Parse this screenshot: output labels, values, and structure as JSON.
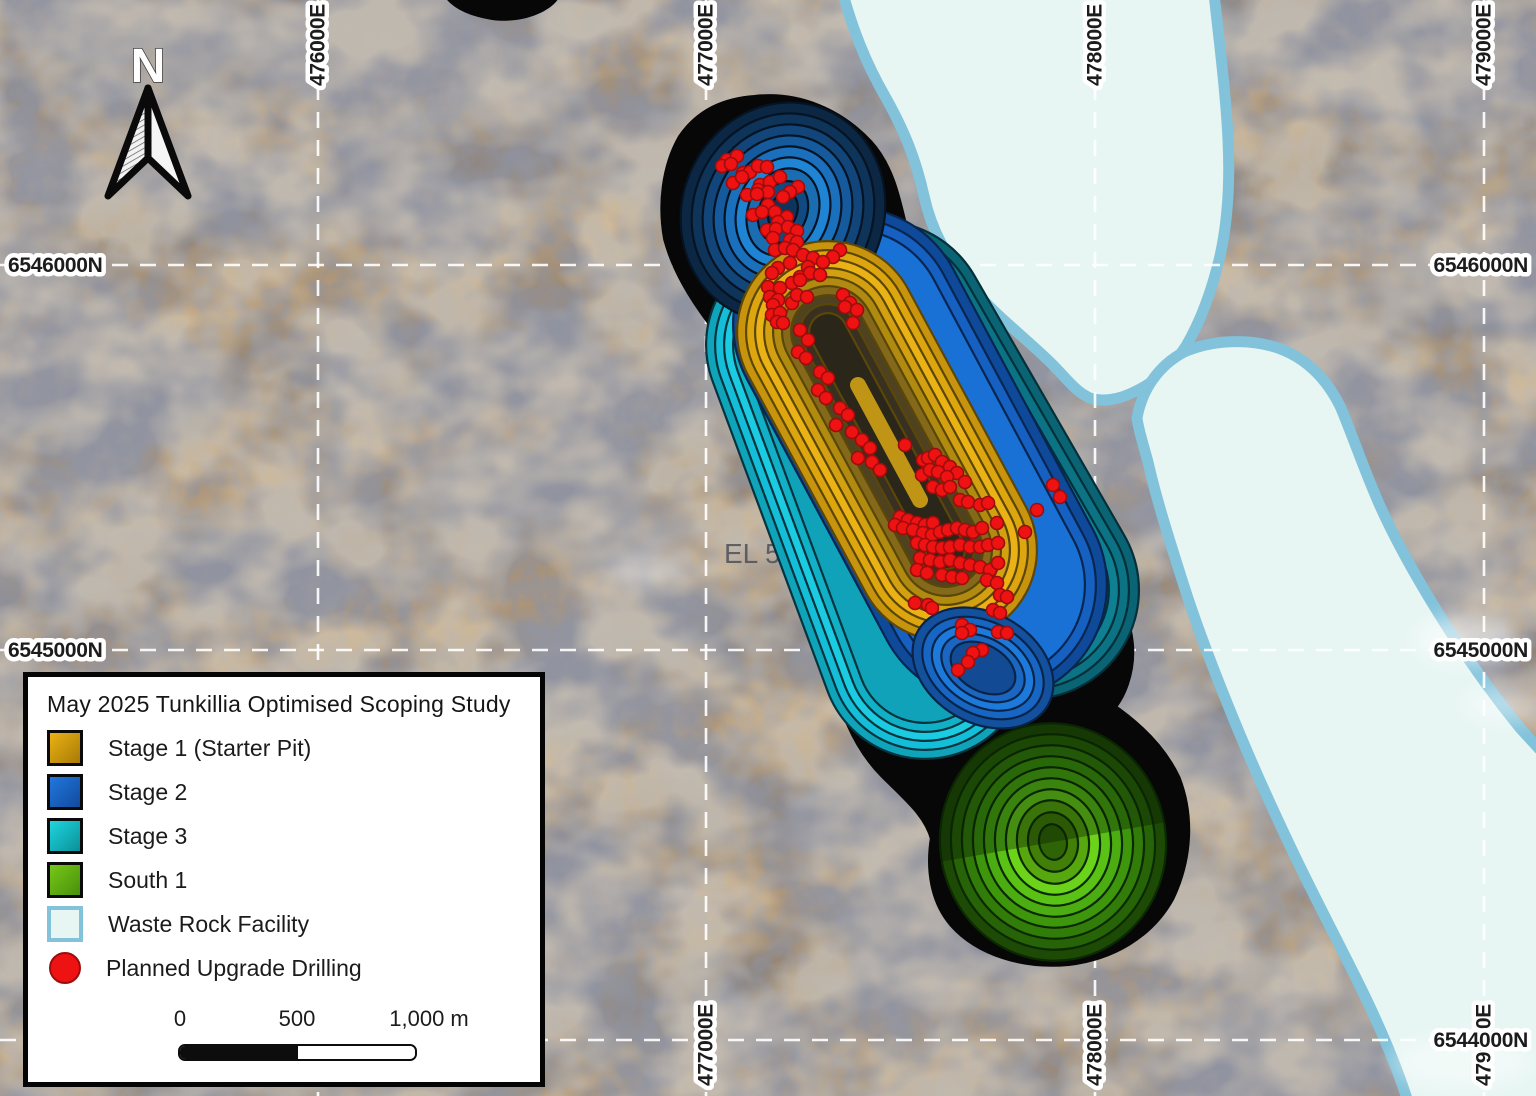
{
  "map_labels": {
    "north_arrow": "N",
    "tenement": "EL 590",
    "eastings_top": [
      {
        "text": "476000E",
        "x": 318
      },
      {
        "text": "477000E",
        "x": 706
      },
      {
        "text": "478000E",
        "x": 1095
      },
      {
        "text": "479000E",
        "x": 1484
      }
    ],
    "eastings_bottom": [
      {
        "text": "477000E",
        "x": 706
      },
      {
        "text": "478000E",
        "x": 1095
      },
      {
        "text": "479000E",
        "x": 1484
      }
    ],
    "northings_left": [
      {
        "text": "6546000N",
        "y": 265
      },
      {
        "text": "6545000N",
        "y": 650
      }
    ],
    "northings_right": [
      {
        "text": "6546000N",
        "y": 265
      },
      {
        "text": "6545000N",
        "y": 650
      },
      {
        "text": "6544000N",
        "y": 1040
      }
    ],
    "gridlines": {
      "vertical_x": [
        318,
        706,
        1095,
        1484
      ],
      "horizontal_y": [
        265,
        650,
        1040
      ]
    }
  },
  "legend": {
    "title": "May 2025 Tunkillia Optimised Scoping Study",
    "items": [
      {
        "label": "Stage 1 (Starter Pit)",
        "kind": "pit",
        "color": "#eab214",
        "color2": "#a87a07"
      },
      {
        "label": "Stage 2",
        "kind": "pit",
        "color": "#2277dd",
        "color2": "#114a9e"
      },
      {
        "label": "Stage 3",
        "kind": "pit",
        "color": "#1fd6de",
        "color2": "#0a8f98"
      },
      {
        "label": "South 1",
        "kind": "pit",
        "color": "#76c816",
        "color2": "#49900c"
      },
      {
        "label": "Waste Rock Facility",
        "kind": "area",
        "color": "#e7f6f3",
        "border": "#82c3db"
      },
      {
        "label": "Planned Upgrade Drilling",
        "kind": "point",
        "color": "#ee1212"
      }
    ],
    "scale_bar": {
      "tick_labels": [
        "0",
        "500",
        "1,000 m"
      ]
    }
  },
  "colors": {
    "stage1_gold": "#e0a70e",
    "stage2_blue": "#1560c0",
    "stage3_cyan": "#15bed8",
    "stage3_teal": "#0c7384",
    "south1_green": "#59c215",
    "waste_rock_fill": "#e7f6f3",
    "waste_rock_border": "#82c3db",
    "drill_red": "#ee1212",
    "drill_red_edge": "#9c0d0d",
    "grid_white": "#ffffff",
    "pit_outline": "#070707"
  },
  "drill_points": [
    [
      727,
      160
    ],
    [
      737,
      156
    ],
    [
      722,
      166
    ],
    [
      731,
      164
    ],
    [
      743,
      173
    ],
    [
      750,
      172
    ],
    [
      758,
      166
    ],
    [
      767,
      167
    ],
    [
      733,
      183
    ],
    [
      742,
      177
    ],
    [
      760,
      185
    ],
    [
      770,
      182
    ],
    [
      780,
      177
    ],
    [
      758,
      190
    ],
    [
      768,
      192
    ],
    [
      798,
      187
    ],
    [
      790,
      192
    ],
    [
      747,
      195
    ],
    [
      757,
      194
    ],
    [
      783,
      197
    ],
    [
      768,
      205
    ],
    [
      775,
      212
    ],
    [
      753,
      215
    ],
    [
      762,
      212
    ],
    [
      787,
      217
    ],
    [
      778,
      222
    ],
    [
      767,
      230
    ],
    [
      776,
      229
    ],
    [
      788,
      227
    ],
    [
      797,
      231
    ],
    [
      773,
      238
    ],
    [
      790,
      240
    ],
    [
      797,
      242
    ],
    [
      775,
      250
    ],
    [
      785,
      248
    ],
    [
      793,
      250
    ],
    [
      803,
      255
    ],
    [
      813,
      258
    ],
    [
      840,
      250
    ],
    [
      833,
      257
    ],
    [
      823,
      262
    ],
    [
      808,
      267
    ],
    [
      778,
      268
    ],
    [
      790,
      263
    ],
    [
      772,
      273
    ],
    [
      800,
      277
    ],
    [
      810,
      273
    ],
    [
      820,
      275
    ],
    [
      768,
      287
    ],
    [
      780,
      288
    ],
    [
      792,
      283
    ],
    [
      800,
      280
    ],
    [
      770,
      297
    ],
    [
      778,
      300
    ],
    [
      773,
      305
    ],
    [
      792,
      303
    ],
    [
      797,
      295
    ],
    [
      807,
      297
    ],
    [
      843,
      295
    ],
    [
      850,
      303
    ],
    [
      845,
      307
    ],
    [
      772,
      315
    ],
    [
      780,
      313
    ],
    [
      777,
      322
    ],
    [
      783,
      323
    ],
    [
      853,
      323
    ],
    [
      857,
      310
    ],
    [
      800,
      330
    ],
    [
      808,
      340
    ],
    [
      798,
      352
    ],
    [
      806,
      358
    ],
    [
      820,
      372
    ],
    [
      828,
      378
    ],
    [
      818,
      390
    ],
    [
      826,
      398
    ],
    [
      840,
      408
    ],
    [
      848,
      415
    ],
    [
      836,
      425
    ],
    [
      852,
      432
    ],
    [
      862,
      440
    ],
    [
      870,
      448
    ],
    [
      858,
      458
    ],
    [
      872,
      462
    ],
    [
      905,
      445
    ],
    [
      880,
      470
    ],
    [
      1053,
      485
    ],
    [
      1060,
      497
    ],
    [
      1037,
      510
    ],
    [
      1025,
      532
    ],
    [
      923,
      460
    ],
    [
      928,
      458
    ],
    [
      935,
      455
    ],
    [
      942,
      462
    ],
    [
      950,
      467
    ],
    [
      957,
      473
    ],
    [
      965,
      482
    ],
    [
      922,
      475
    ],
    [
      930,
      470
    ],
    [
      938,
      472
    ],
    [
      947,
      477
    ],
    [
      933,
      487
    ],
    [
      942,
      490
    ],
    [
      950,
      487
    ],
    [
      960,
      500
    ],
    [
      968,
      502
    ],
    [
      980,
      505
    ],
    [
      988,
      503
    ],
    [
      900,
      517
    ],
    [
      908,
      520
    ],
    [
      917,
      523
    ],
    [
      925,
      525
    ],
    [
      933,
      523
    ],
    [
      895,
      525
    ],
    [
      903,
      528
    ],
    [
      913,
      530
    ],
    [
      923,
      533
    ],
    [
      932,
      535
    ],
    [
      940,
      532
    ],
    [
      948,
      530
    ],
    [
      957,
      528
    ],
    [
      965,
      530
    ],
    [
      973,
      532
    ],
    [
      982,
      528
    ],
    [
      997,
      523
    ],
    [
      917,
      543
    ],
    [
      925,
      545
    ],
    [
      933,
      547
    ],
    [
      942,
      548
    ],
    [
      950,
      547
    ],
    [
      960,
      545
    ],
    [
      970,
      547
    ],
    [
      980,
      547
    ],
    [
      988,
      545
    ],
    [
      998,
      543
    ],
    [
      920,
      558
    ],
    [
      930,
      560
    ],
    [
      940,
      562
    ],
    [
      950,
      560
    ],
    [
      960,
      563
    ],
    [
      970,
      565
    ],
    [
      980,
      567
    ],
    [
      990,
      570
    ],
    [
      998,
      563
    ],
    [
      917,
      570
    ],
    [
      927,
      573
    ],
    [
      942,
      575
    ],
    [
      952,
      577
    ],
    [
      962,
      578
    ],
    [
      987,
      580
    ],
    [
      997,
      583
    ],
    [
      1000,
      595
    ],
    [
      1007,
      597
    ],
    [
      915,
      603
    ],
    [
      928,
      605
    ],
    [
      932,
      608
    ],
    [
      993,
      610
    ],
    [
      1000,
      613
    ],
    [
      962,
      625
    ],
    [
      970,
      630
    ],
    [
      962,
      633
    ],
    [
      998,
      632
    ],
    [
      1007,
      633
    ],
    [
      982,
      650
    ],
    [
      973,
      653
    ],
    [
      968,
      662
    ],
    [
      958,
      670
    ]
  ]
}
